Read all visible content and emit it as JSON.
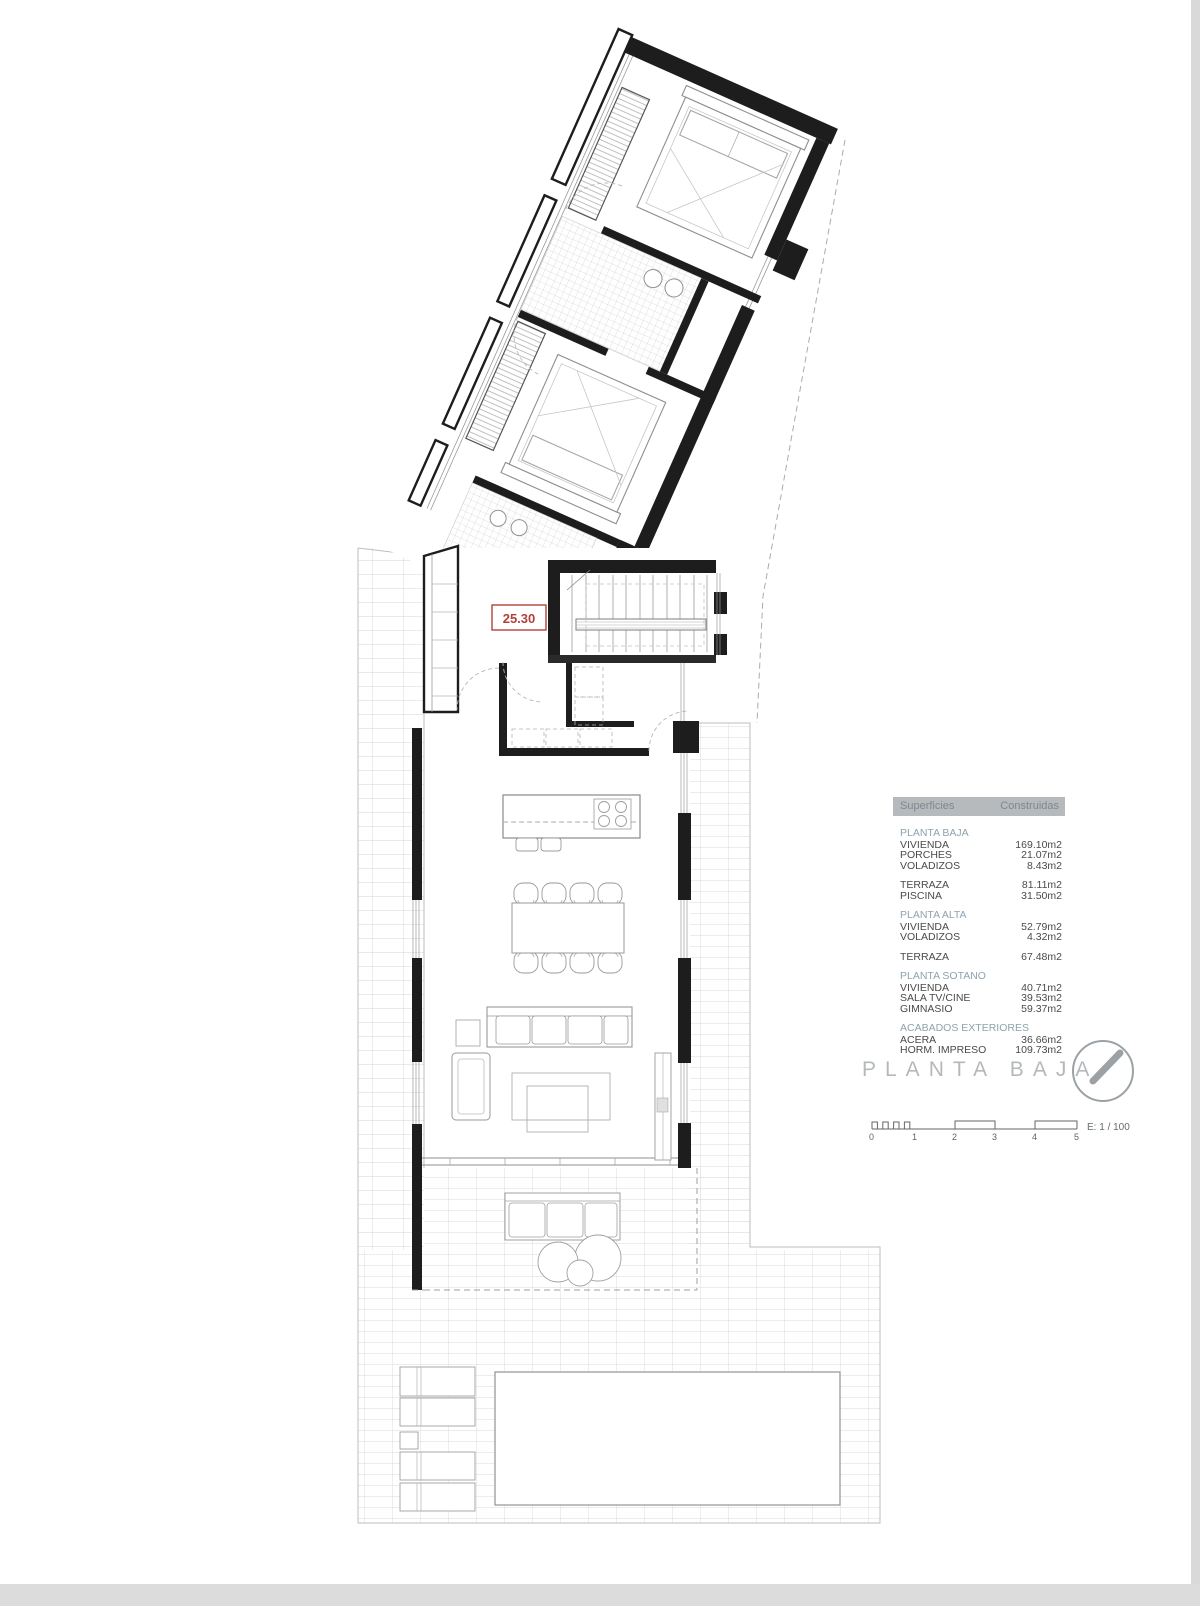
{
  "plan": {
    "level_label": "25.30",
    "title": "PLANTA BAJA",
    "scale_label": "E: 1 / 100",
    "scale_ticks": [
      "0",
      "1",
      "2",
      "3",
      "4",
      "5"
    ]
  },
  "surfaces_table": {
    "col_label": "Superficies",
    "col_value": "Construidas",
    "sections": [
      {
        "name": "PLANTA BAJA",
        "rows": [
          {
            "label": "VIVIENDA",
            "value": "169.10m2"
          },
          {
            "label": "PORCHES",
            "value": "21.07m2"
          },
          {
            "label": "VOLADIZOS",
            "value": "8.43m2"
          }
        ]
      },
      {
        "name": null,
        "rows": [
          {
            "label": "TERRAZA",
            "value": "81.11m2"
          },
          {
            "label": "PISCINA",
            "value": "31.50m2"
          }
        ]
      },
      {
        "name": "PLANTA ALTA",
        "rows": [
          {
            "label": "VIVIENDA",
            "value": "52.79m2"
          },
          {
            "label": "VOLADIZOS",
            "value": "4.32m2"
          }
        ]
      },
      {
        "name": null,
        "rows": [
          {
            "label": "TERRAZA",
            "value": "67.48m2"
          }
        ]
      },
      {
        "name": "PLANTA SOTANO",
        "rows": [
          {
            "label": "VIVIENDA",
            "value": "40.71m2"
          },
          {
            "label": "SALA TV/CINE",
            "value": "39.53m2"
          },
          {
            "label": "GIMNASIO",
            "value": "59.37m2"
          }
        ]
      },
      {
        "name": "ACABADOS EXTERIORES",
        "rows": [
          {
            "label": "ACERA",
            "value": "36.66m2"
          },
          {
            "label": "HORM. IMPRESO",
            "value": "109.73m2"
          }
        ]
      }
    ]
  },
  "colors": {
    "accent_red": "#b0413a",
    "header_bg": "#b7babc",
    "header_text": "#7d8793",
    "section_text": "#8fa3ad",
    "body_text": "#4a4a4a",
    "wall": "#1d1d1d"
  }
}
